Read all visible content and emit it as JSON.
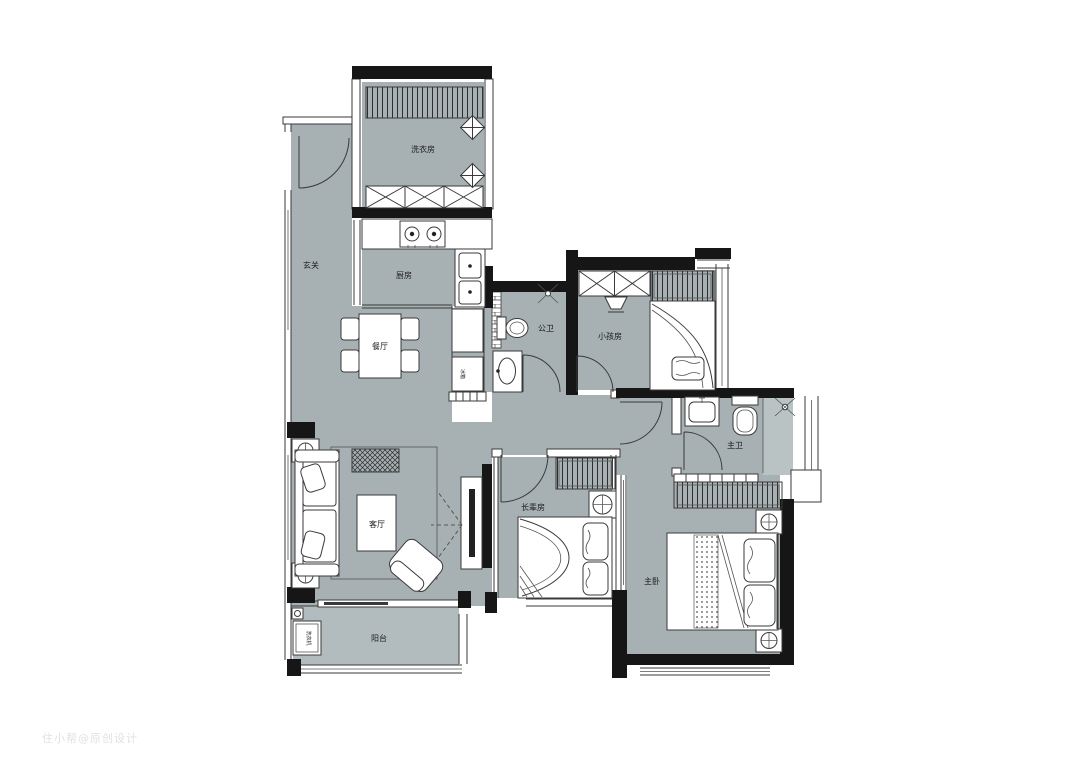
{
  "title": "apartment-floor-plan",
  "palette": {
    "floor": "#a7b1b3",
    "floor_light": "#b2bcbe",
    "floor_shower": "#b9c3c4",
    "wall": "#161616",
    "line": "#3a3a3a",
    "label": "#1c1c1c",
    "watermark": "#dcdcdc"
  },
  "rooms": {
    "laundry": {
      "label": "洗衣房"
    },
    "kitchen": {
      "label": "厨房"
    },
    "entry": {
      "label": "玄关"
    },
    "dining": {
      "label": "餐厅"
    },
    "living": {
      "label": "客厅"
    },
    "balcony": {
      "label": "阳台"
    },
    "bath_public": {
      "label": "公卫"
    },
    "kids": {
      "label": "小孩房"
    },
    "elder": {
      "label": "长辈房"
    },
    "master": {
      "label": "主卧"
    },
    "bath_master": {
      "label": "主卫"
    }
  },
  "appliances": {
    "washer": "洗衣机",
    "fridge": "冰箱"
  },
  "watermark": "住小帮@原创设计"
}
